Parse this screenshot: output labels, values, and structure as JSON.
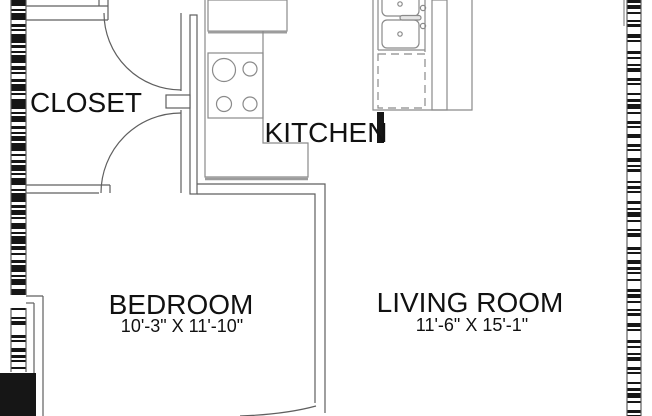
{
  "rooms": {
    "closet": {
      "label": "CLOSET"
    },
    "kitchen": {
      "label": "KITCHEN"
    },
    "bedroom": {
      "label": "BEDROOM",
      "dimensions": "10'-3\" X 11'-10\""
    },
    "living_room": {
      "label": "LIVING ROOM",
      "dimensions": "11'-6\" X 15'-1\""
    }
  },
  "fixtures": {
    "refrigerator": "refrigerator",
    "stove": "stove-4-burner",
    "sink": "double-basin-sink",
    "dishwasher": "dishwasher",
    "closet_doors": "double-swing-doors",
    "bedroom_door": "door-swing-arc"
  },
  "colors": {
    "background": "#ffffff",
    "wall_hatch": "#161616",
    "wall_line": "#5f5f5f",
    "fixture_line": "#8a8a8a",
    "counter_accent": "#9c9c9c",
    "text": "#111111"
  }
}
